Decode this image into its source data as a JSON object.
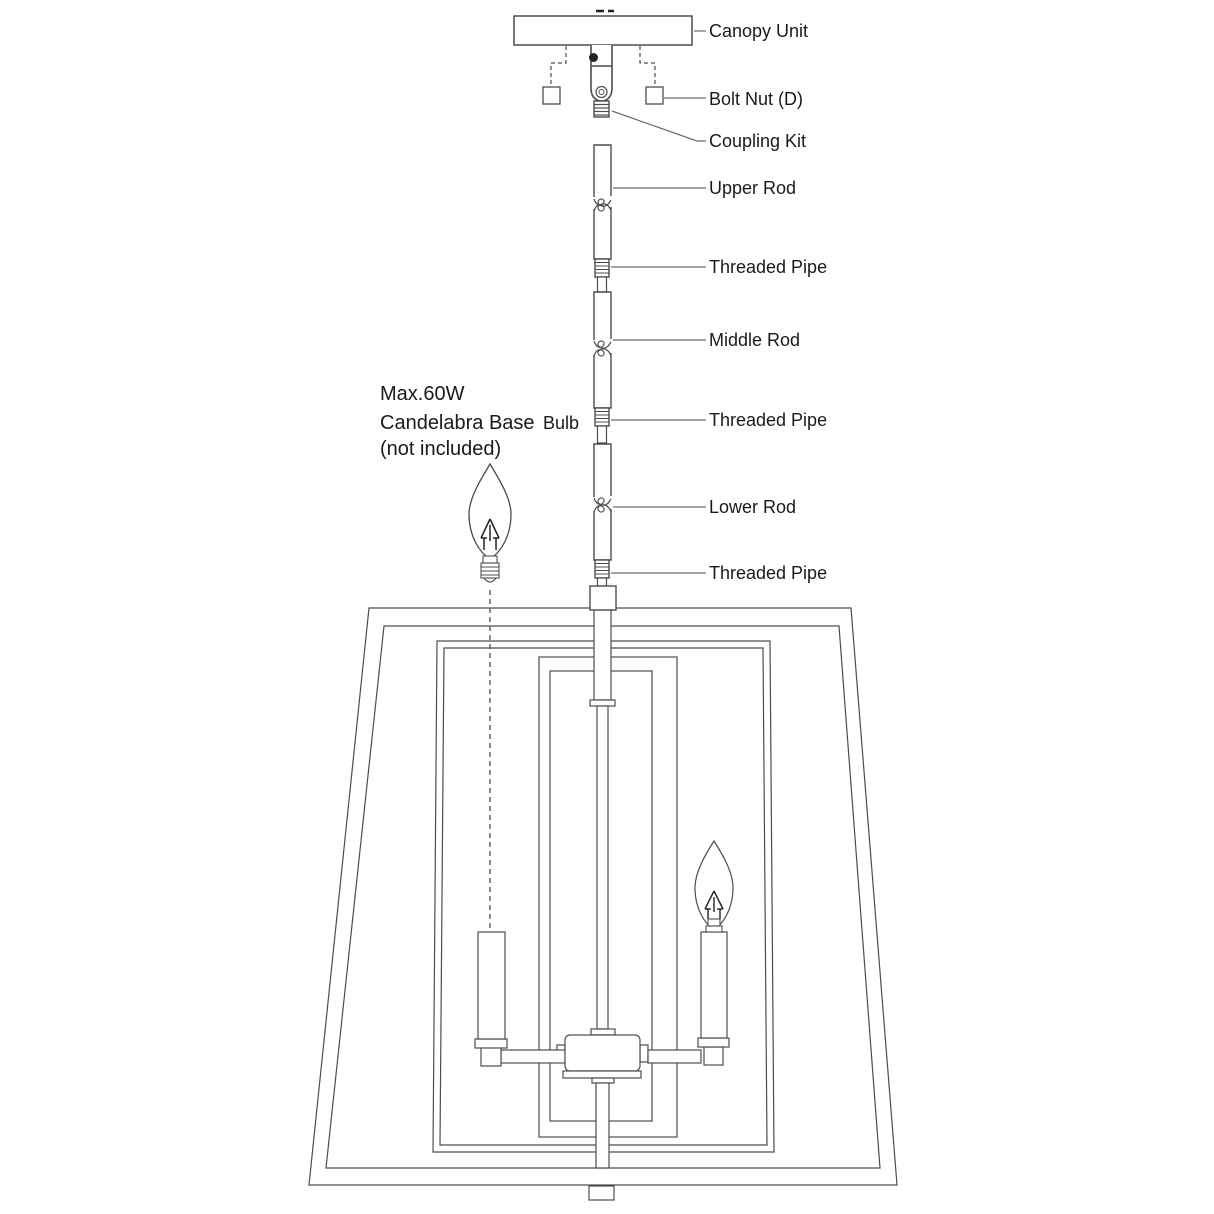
{
  "diagram": {
    "part_labels": {
      "canopy_unit": "Canopy Unit",
      "bolt_nut": "Bolt Nut (D)",
      "coupling_kit": "Coupling Kit",
      "upper_rod": "Upper Rod",
      "threaded_pipe": "Threaded Pipe",
      "middle_rod": "Middle Rod",
      "lower_rod": "Lower Rod"
    },
    "bulb_note": {
      "line1": "Max.60W",
      "line2": "Candelabra Base",
      "line2_suffix": "Bulb",
      "line3": "(not included)"
    },
    "colors": {
      "ink": "#4d4d4d",
      "leader": "#6b6b6b",
      "text": "#1a1a1a",
      "background": "#ffffff"
    }
  }
}
